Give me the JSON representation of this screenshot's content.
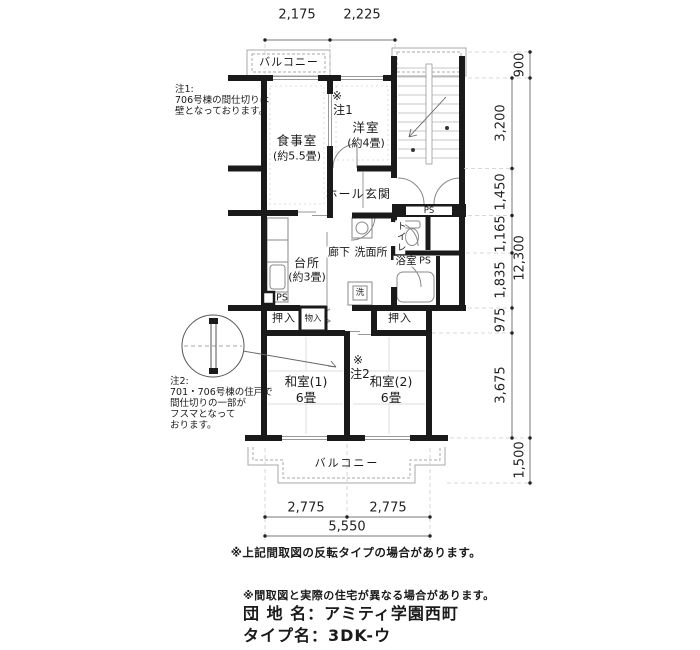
{
  "dimensions": {
    "top": [
      "2,175",
      "2,225"
    ],
    "bottom": [
      "2,775",
      "2,775"
    ],
    "bottom_total": "5,550",
    "right": [
      "900",
      "3,200",
      "1,450",
      "1,165",
      "1,835",
      "975",
      "3,675",
      "1,500"
    ],
    "right_total": "12,300"
  },
  "rooms": {
    "balcony_top": "バルコニー",
    "dining": "食事室",
    "dining_size": "(約5.5畳)",
    "western": "洋室",
    "western_size": "(約4畳)",
    "hall": "ホール",
    "entrance": "玄関",
    "kitchen": "台所",
    "kitchen_size": "(約3畳)",
    "corridor": "廊下",
    "washroom": "洗面所",
    "toilet": "トイレ",
    "bath": "浴室",
    "washer": "洗",
    "ps": "PS",
    "closet_left": "押入",
    "storage": "物入",
    "closet_right": "押入",
    "japanese1": "和室(1)",
    "japanese1_size": "6畳",
    "japanese2": "和室(2)",
    "japanese2_size": "6畳",
    "balcony_bottom": "バルコニー"
  },
  "marks": {
    "note1_sign": "※",
    "note1_ref": "注1",
    "note2_sign": "※",
    "note2_ref": "注2"
  },
  "notes": {
    "note1_lines": [
      "注1:",
      "706号棟の間仕切りは",
      "壁となっております。"
    ],
    "note2_lines": [
      "注2:",
      "701・706号棟の住戸で",
      "間仕切りの一部が",
      "フスマとなって",
      "おります。"
    ]
  },
  "footer": {
    "flip_note": "※上記間取図の反転タイプの場合があります。",
    "differ_note": "※間取図と実際の住宅が異なる場合があります。",
    "estate_name": "団 地 名：アミティ学園西町",
    "type_name": "タイプ名：3DK-ウ"
  },
  "colors": {
    "wall": "#1a1a1a",
    "fixture_line": "#888888",
    "light_line": "#bbbbbb",
    "text": "#1a1a1a"
  }
}
